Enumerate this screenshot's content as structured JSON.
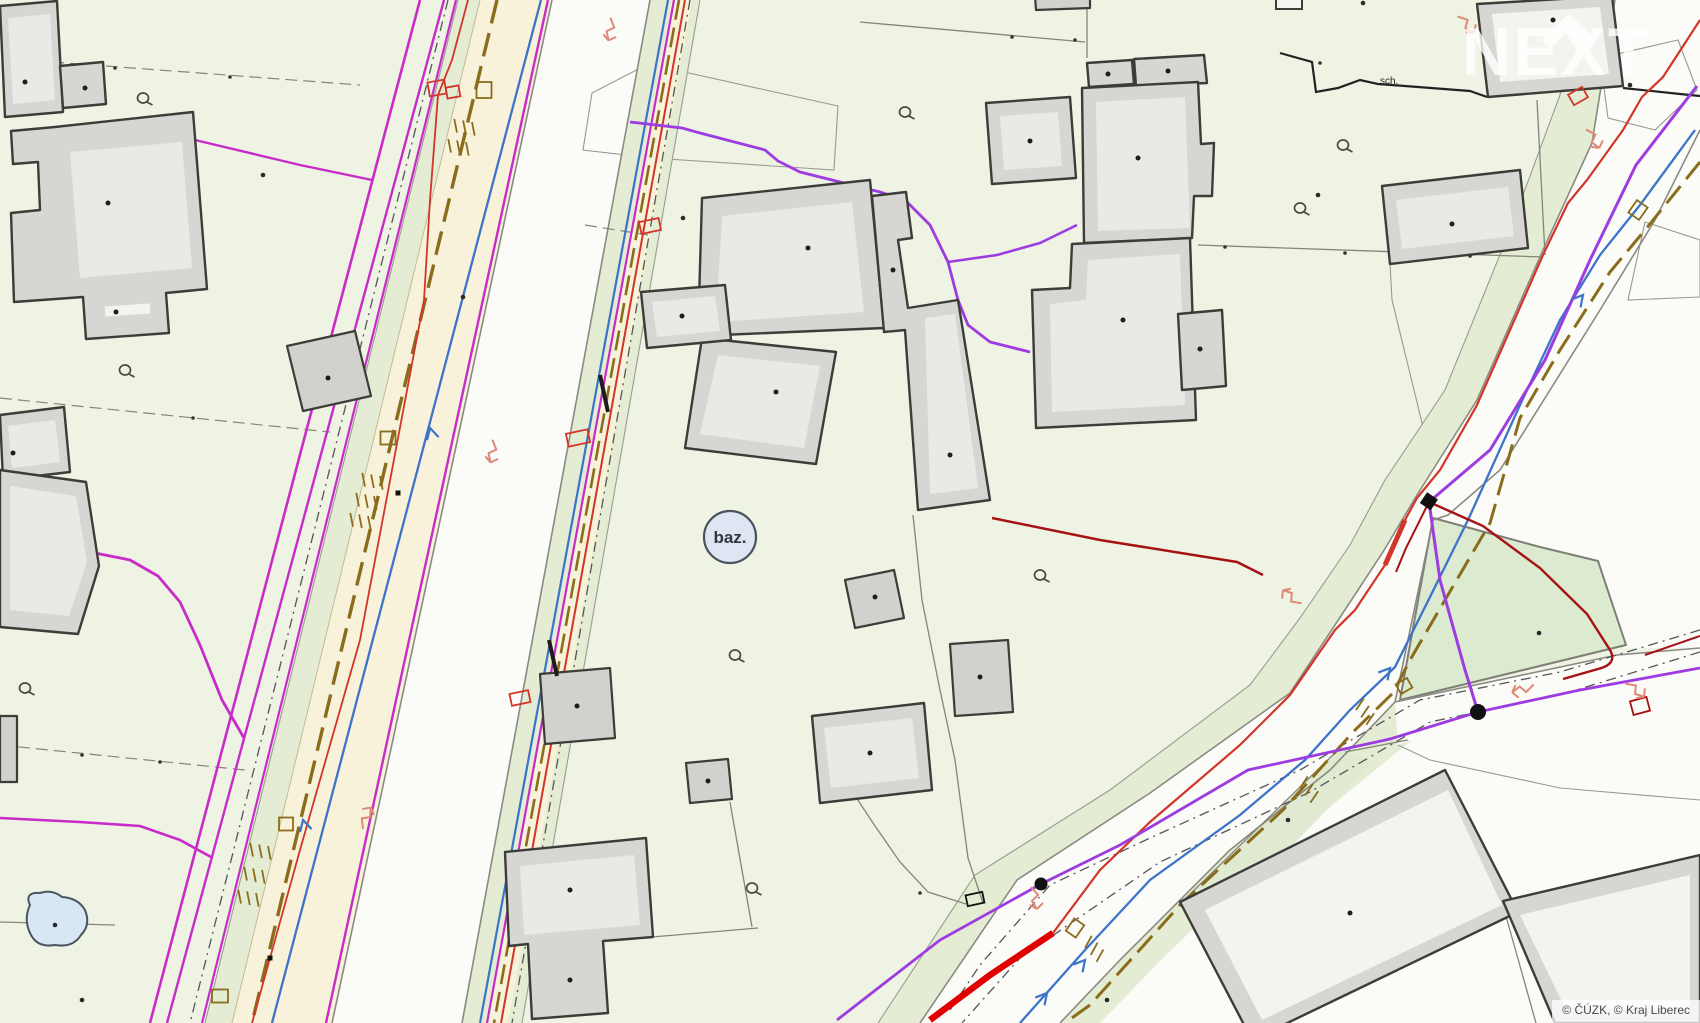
{
  "map": {
    "title": "cadastral utility map",
    "labels": {
      "pool": "baz.",
      "stairs": "sch."
    },
    "watermark": {
      "text": "NEXT"
    },
    "attribution": {
      "text": "© ČÚZK, © Kraj Liberec"
    },
    "colors": {
      "background": "#eef3e4",
      "road_white": "#fbfbf8",
      "verge_green": "#e4edd3",
      "island_green": "#dcead0",
      "beige_strip": "#f8f2da",
      "building_fill": "#d7d6d2",
      "building_inset": "#ebe9e5",
      "building_stroke": "#3c3c38",
      "boundary_gray": "#85857c",
      "water_magenta": "#c92bc9",
      "violet": "#9d3ce0",
      "electric_red": "#d2352a",
      "dark_red": "#a61214",
      "thick_red": "#e00000",
      "telecom_blue": "#3b74c9",
      "gas_olive": "#8a6d1c",
      "salmon": "#dd8a78",
      "pond_fill": "#d8e7f6",
      "pond_stroke": "#4a5560",
      "pool_fill": "#dde6f2",
      "pool_stroke": "#4a525e",
      "symbol_gray": "#4a4a45",
      "dot_black": "#1e1e1e"
    },
    "symbols": {
      "garden": [
        [
          143,
          98
        ],
        [
          125,
          370
        ],
        [
          25,
          688
        ],
        [
          735,
          655
        ],
        [
          905,
          112
        ],
        [
          1343,
          145
        ],
        [
          1300,
          208
        ],
        [
          752,
          888
        ],
        [
          1040,
          575
        ]
      ],
      "parcel_dots": [
        [
          263,
          175
        ],
        [
          683,
          218
        ],
        [
          82,
          1000
        ],
        [
          1318,
          195
        ],
        [
          1363,
          3
        ],
        [
          1539,
          633
        ],
        [
          1288,
          820
        ],
        [
          1630,
          85
        ],
        [
          1107,
          1000
        ],
        [
          55,
          925
        ],
        [
          463,
          297
        ]
      ],
      "building_dots": [
        [
          25,
          82
        ],
        [
          85,
          88
        ],
        [
          108,
          203
        ],
        [
          116,
          312
        ],
        [
          328,
          378
        ],
        [
          13,
          453
        ],
        [
          808,
          248
        ],
        [
          776,
          392
        ],
        [
          682,
          316
        ],
        [
          893,
          270
        ],
        [
          950,
          455
        ],
        [
          1030,
          141
        ],
        [
          1108,
          74
        ],
        [
          1168,
          71
        ],
        [
          1138,
          158
        ],
        [
          1123,
          320
        ],
        [
          1200,
          349
        ],
        [
          1452,
          224
        ],
        [
          1553,
          20
        ],
        [
          1350,
          913
        ],
        [
          570,
          890
        ],
        [
          570,
          980
        ],
        [
          577,
          706
        ],
        [
          708,
          781
        ],
        [
          870,
          753
        ],
        [
          980,
          677
        ],
        [
          875,
          597
        ]
      ],
      "node_dots": [
        [
          115,
          68
        ],
        [
          230,
          77
        ],
        [
          193,
          418
        ],
        [
          82,
          755
        ],
        [
          160,
          762
        ],
        [
          1225,
          247
        ],
        [
          1345,
          253
        ],
        [
          1470,
          256
        ],
        [
          1320,
          63
        ],
        [
          920,
          893
        ],
        [
          1012,
          37
        ],
        [
          1075,
          40
        ]
      ],
      "valves": [
        [
          398,
          493
        ],
        [
          270,
          958
        ]
      ],
      "red_boxes": [
        {
          "x": 437,
          "y": 88,
          "w": 17,
          "h": 14,
          "a": -10
        },
        {
          "x": 453,
          "y": 92,
          "w": 13,
          "h": 11,
          "a": -10
        },
        {
          "x": 650,
          "y": 226,
          "w": 20,
          "h": 12,
          "a": -12
        },
        {
          "x": 578,
          "y": 438,
          "w": 22,
          "h": 13,
          "a": -12
        },
        {
          "x": 520,
          "y": 698,
          "w": 19,
          "h": 12,
          "a": -12
        },
        {
          "x": 1578,
          "y": 96,
          "w": 16,
          "h": 12,
          "a": -30
        },
        {
          "x": 1640,
          "y": 706,
          "w": 17,
          "h": 14,
          "a": -15,
          "c": "#a61214"
        },
        {
          "x": 975,
          "y": 899,
          "w": 17,
          "h": 11,
          "a": -12,
          "c": "#111111"
        }
      ],
      "olive_boxes": [
        {
          "x": 484,
          "y": 90,
          "w": 15,
          "h": 16,
          "a": 0
        },
        {
          "x": 388,
          "y": 438,
          "w": 15,
          "h": 13,
          "a": 0
        },
        {
          "x": 286,
          "y": 824,
          "w": 14,
          "h": 13,
          "a": 0
        },
        {
          "x": 220,
          "y": 996,
          "w": 16,
          "h": 13,
          "a": 0
        },
        {
          "x": 1638,
          "y": 210,
          "w": 15,
          "h": 13,
          "a": -55
        },
        {
          "x": 1075,
          "y": 928,
          "w": 15,
          "h": 12,
          "a": -55
        },
        {
          "x": 1404,
          "y": 686,
          "w": 13,
          "h": 11,
          "a": -30
        }
      ],
      "combs": [
        [
          380,
          476,
          100
        ],
        [
          374,
          496,
          100
        ],
        [
          368,
          516,
          100
        ],
        [
          268,
          846,
          100
        ],
        [
          262,
          870,
          100
        ],
        [
          256,
          893,
          100
        ],
        [
          1356,
          710,
          -35
        ],
        [
          1300,
          788,
          -35
        ],
        [
          1085,
          948,
          -40
        ],
        [
          472,
          122,
          100
        ],
        [
          466,
          142,
          100
        ]
      ],
      "salmon_arrows": [
        [
          1287,
          592,
          -40
        ],
        [
          1516,
          690,
          -95
        ],
        [
          1596,
          145,
          160
        ],
        [
          370,
          812,
          35
        ],
        [
          608,
          36,
          200
        ],
        [
          1035,
          905,
          180
        ],
        [
          1470,
          30,
          150
        ],
        [
          490,
          458,
          200
        ],
        [
          1640,
          695,
          140
        ]
      ],
      "blue_arrows": [
        [
          430,
          428,
          -15
        ],
        [
          303,
          820,
          -15
        ],
        [
          1390,
          668,
          40
        ],
        [
          1085,
          960,
          40
        ],
        [
          1047,
          993,
          40
        ],
        [
          1583,
          295,
          40
        ]
      ]
    }
  }
}
